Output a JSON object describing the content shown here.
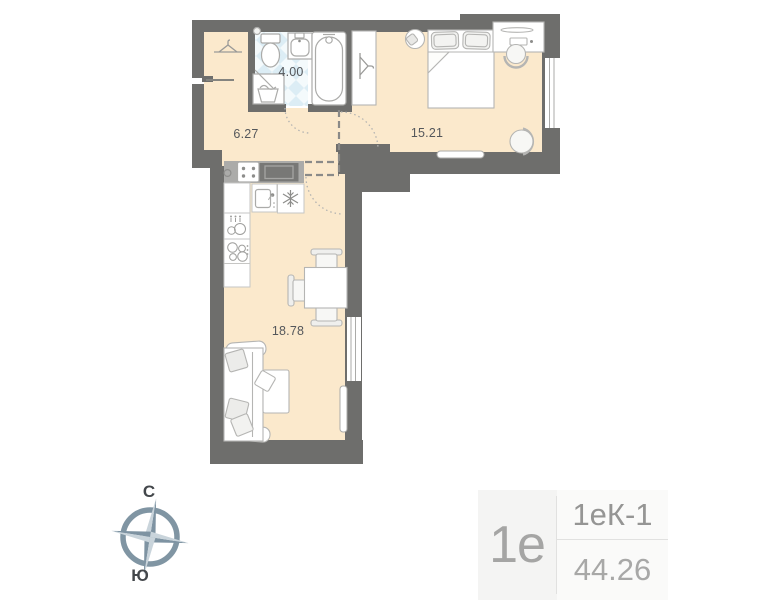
{
  "rooms": {
    "bathroom": {
      "area": "4.00"
    },
    "hallway": {
      "area": "6.27"
    },
    "bedroom": {
      "area": "15.21"
    },
    "living_kitchen": {
      "area": "18.78"
    }
  },
  "compass": {
    "north_label": "С",
    "south_label": "Ю"
  },
  "unit_card": {
    "plan_type": "1е",
    "layout_code": "1еК-1",
    "total_area": "44.26"
  },
  "colors": {
    "wall": "#6E6E6C",
    "floor_beige": "#FBE9CC",
    "tile_blue": "#DCEDF5",
    "furniture_outline": "#B5B5B3",
    "counter_gray": "#ABABA9",
    "appliance_dark": "#787876",
    "compass_dark": "#7E93A2",
    "compass_light": "#C9D4DB",
    "label_text": "#54575B",
    "card_bg": "#F4F4F3",
    "card_divider": "#E1E1E0",
    "card_text": "#9C9C9B"
  },
  "icons": {
    "fridge_icon": "❄",
    "hanger_icon": "clothes-hanger shape",
    "compass_icon": "4-point star in ring"
  }
}
